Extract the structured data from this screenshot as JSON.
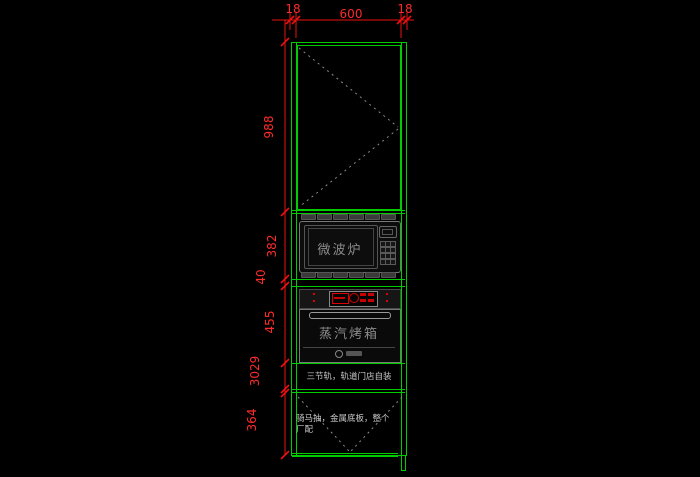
{
  "title": "cabinet-elevation-cad-drawing",
  "dimensions": {
    "top": {
      "left_panel": "18",
      "overall_width": "600",
      "right_panel": "18"
    },
    "left": {
      "upper_door": "988",
      "microwave_section": "382",
      "gap": "40",
      "oven_section": "455",
      "stacked_small_dims": "3029",
      "drawer_section": "364"
    }
  },
  "appliances": {
    "microwave_label": "微波炉",
    "steam_oven_label": "蒸汽烤箱"
  },
  "notes": {
    "rail": "三节轨，轨道门店自装",
    "drawer": [
      "骑马抽，金属底板，整个",
      "厂配"
    ]
  },
  "colors": {
    "background": "#000000",
    "cabinet_line": "#00cc00",
    "dimension": "#ff2a2a",
    "appliance_line": "#777777",
    "appliance_text": "#8a8a8a",
    "note_text": "#c8c8c8",
    "control_red": "#dd0000"
  }
}
